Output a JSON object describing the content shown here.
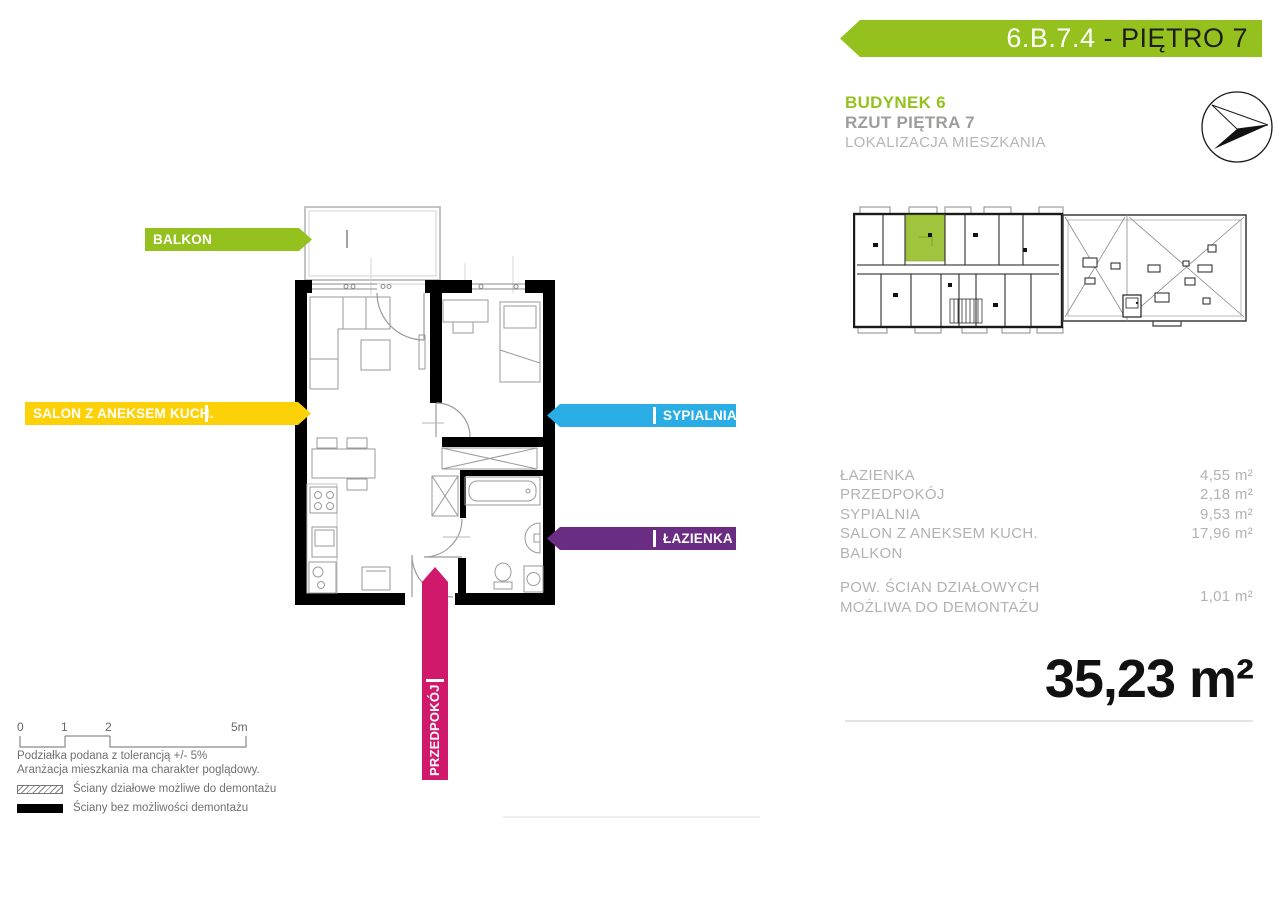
{
  "header": {
    "unit_code": "6.B.7.4",
    "floor_label": " - PIĘTRO 7",
    "building_title": "BUDYNEK 6",
    "floor_plan_title": "RZUT PIĘTRA 7",
    "location_subtitle": "LOKALIZACJA MIESZKANIA"
  },
  "plan_labels": {
    "balkon": "BALKON",
    "salon": "SALON Z ANEKSEM KUCH.",
    "sypialnia": "SYPIALNIA",
    "lazienka": "ŁAZIENKA",
    "przedpokoj": "PRZEDPOKÓJ"
  },
  "areas": {
    "rows": [
      {
        "label": "ŁAZIENKA",
        "value": "4,55 m²"
      },
      {
        "label": "PRZEDPOKÓJ",
        "value": "2,18 m²"
      },
      {
        "label": "SYPIALNIA",
        "value": "9,53 m²"
      },
      {
        "label": "SALON Z ANEKSEM KUCH.",
        "value": "17,96 m²"
      },
      {
        "label": "BALKON",
        "value": ""
      }
    ],
    "partition_label_line1": "POW. ŚCIAN DZIAŁOWYCH",
    "partition_label_line2": "MOŻLIWA DO DEMONTAŻU",
    "partition_value": "1,01 m²",
    "total": "35,23 m²"
  },
  "scale_bar": {
    "tick0": "0",
    "tick1": "1",
    "tick2": "2",
    "tick3": "5m"
  },
  "legend": {
    "note1": "Podziałka podana z tolerancją +/- 5%",
    "note2": "Aranżacja mieszkania ma charakter poglądowy.",
    "items": [
      {
        "swatch": "hatched",
        "label": "Ściany działowe możliwe do demontażu"
      },
      {
        "swatch": "solid",
        "label": "Ściany bez możliwości demontażu"
      }
    ]
  },
  "colors": {
    "brand_green": "#95c11f",
    "salon_yellow": "#fdd108",
    "sypialnia_cyan": "#29ade4",
    "lazienka_purple": "#6b2d84",
    "przedpokoj_magenta": "#d0196a",
    "unit_highlight_green": "#a0c53c",
    "muted_text_gray": "#b2b2b2"
  }
}
